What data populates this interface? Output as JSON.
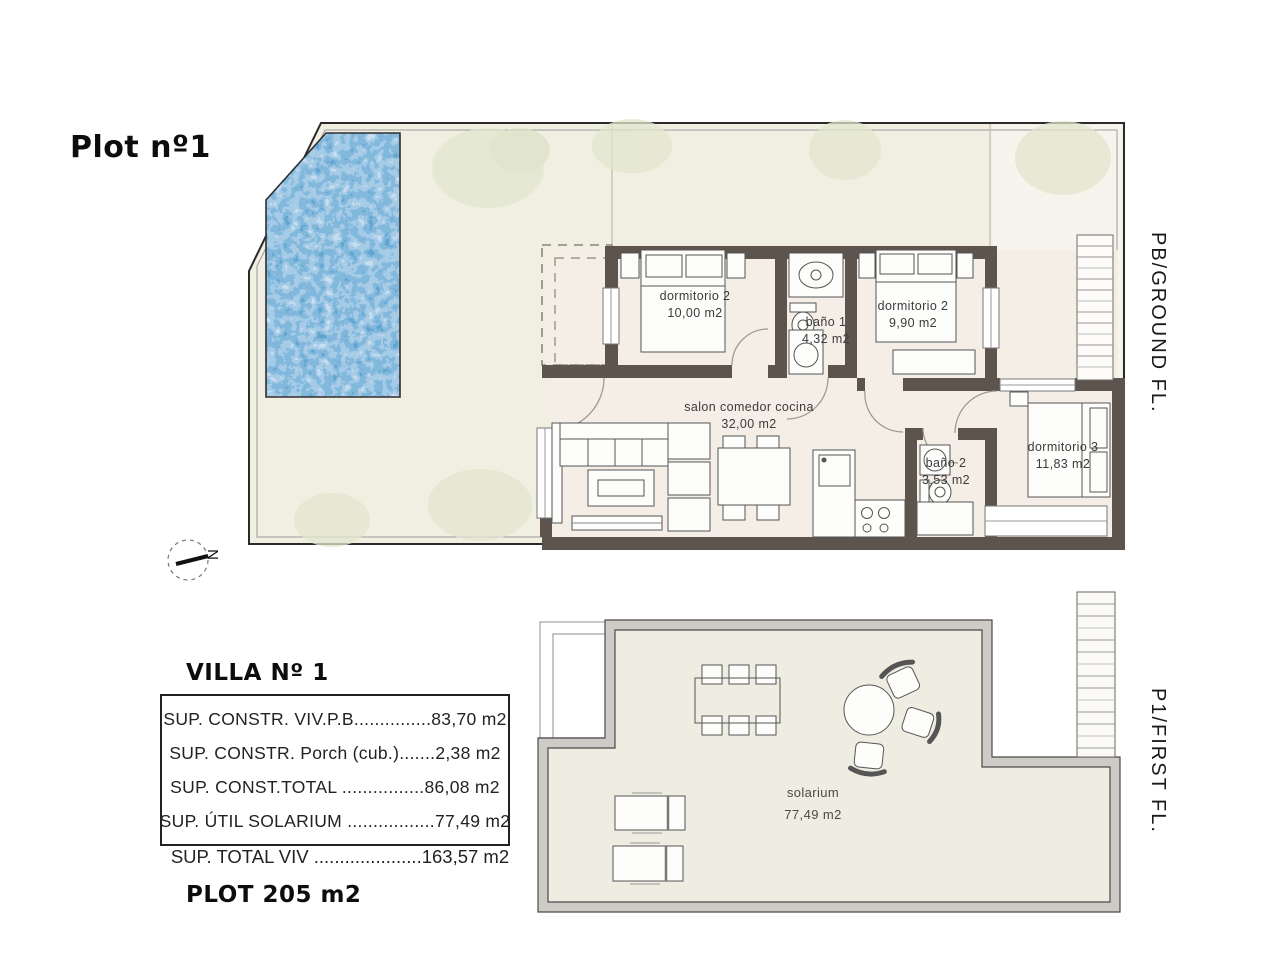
{
  "title": "Plot nº1",
  "floors": {
    "ground": {
      "side_label": "PB/GROUND FL.",
      "rooms": {
        "dorm2a": {
          "name": "dormitorio 2",
          "area": "10,00 m2"
        },
        "bano1": {
          "name": "baño 1",
          "area": "4,32 m2"
        },
        "dorm2b": {
          "name": "dormitorio 2",
          "area": "9,90 m2"
        },
        "salon": {
          "name": "salon comedor cocina",
          "area": "32,00 m2"
        },
        "bano2": {
          "name": "baño 2",
          "area": "3,53 m2"
        },
        "dorm3": {
          "name": "dormitorio 3",
          "area": "11,83 m2"
        }
      }
    },
    "first": {
      "side_label": "P1/FIRST FL.",
      "rooms": {
        "solarium": {
          "name": "solarium",
          "area": "77,49 m2"
        }
      }
    }
  },
  "compass": {
    "north": "N"
  },
  "summary": {
    "heading": "VILLA Nº 1",
    "rows": [
      {
        "text": "SUP. CONSTR. VIV.P.B...............83,70 m2"
      },
      {
        "text": "SUP. CONSTR. Porch (cub.).......2,38 m2"
      },
      {
        "text": "SUP. CONST.TOTAL ................86,08 m2"
      },
      {
        "text": "SUP. ÚTIL SOLARIUM .................77,49 m2"
      }
    ],
    "total": "SUP. TOTAL VIV .....................163,57 m2",
    "plot": "PLOT 205 m2"
  },
  "colors": {
    "wall": "#5d544e",
    "garden": "#f1eee2",
    "room_interior": "#f4eee6",
    "pool_mid_blue": "#3f7fb5",
    "foliage_green": "#e2e6cd"
  }
}
